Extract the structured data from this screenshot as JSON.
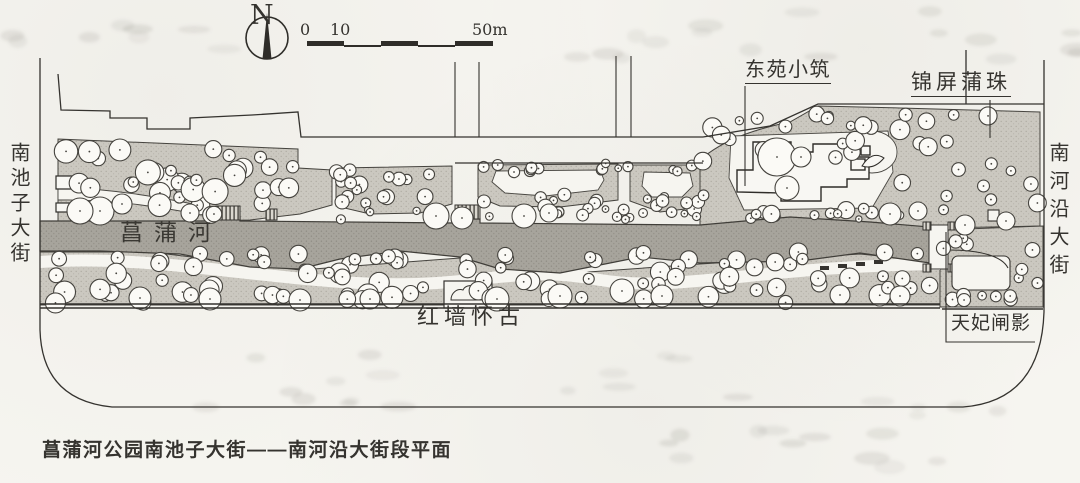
{
  "page": {
    "caption": "菖蒲河公园南池子大街——南河沿大街段平面"
  },
  "compass": {
    "north_label": "N"
  },
  "scale_bar": {
    "tick0": "0",
    "tick10": "10",
    "tick50": "50m"
  },
  "labels": {
    "building_ne": "东苑小筑",
    "scenic_ne": "锦屏蒲珠",
    "river": "菖蒲河",
    "scenic_south": "红墙怀古",
    "scenic_se": "天妃闸影",
    "street_west": "南池子大街",
    "street_east": "南河沿大街"
  },
  "colors": {
    "ink": "#35332f",
    "paper": "#f6f5f0",
    "planting": "#cbc8c0",
    "water": "#a7a49c"
  }
}
